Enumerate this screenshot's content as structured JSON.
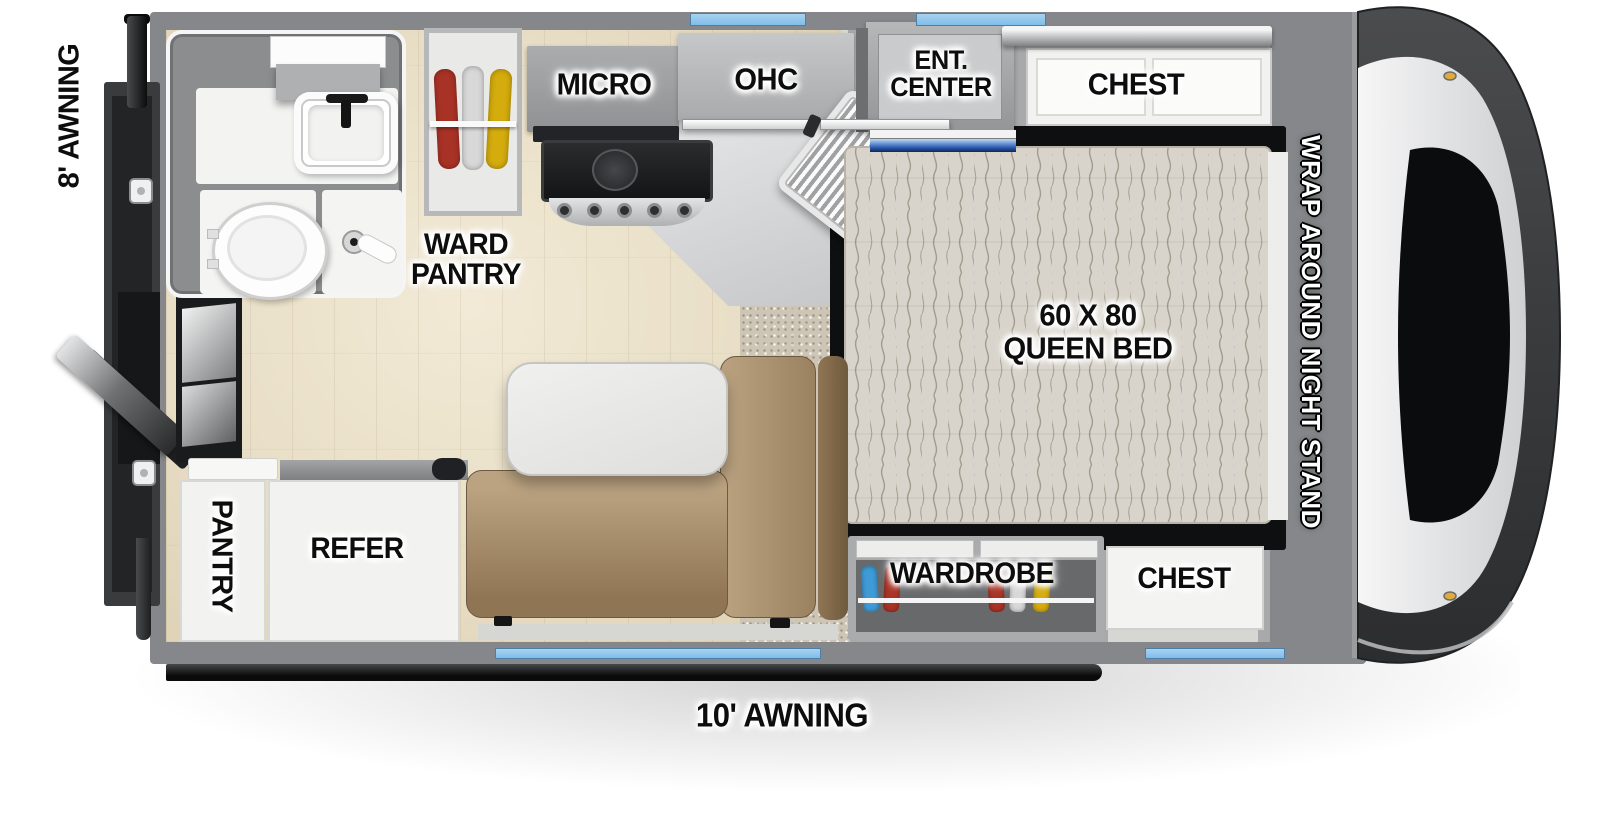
{
  "labels": {
    "awning_left": "8' AWNING",
    "awning_bottom": "10' AWNING",
    "ward_pantry": "WARD PANTRY",
    "micro": "MICRO",
    "ohc": "OHC",
    "ent_center": "ENT. CENTER",
    "chest_front": "CHEST",
    "queen_bed": "60 X 80 QUEEN BED",
    "night_stand": "WRAP AROUND NIGHT STAND",
    "wardrobe": "WARDROBE",
    "chest_rear": "CHEST",
    "pantry": "PANTRY",
    "refer": "REFER"
  },
  "colors": {
    "window_accent": "#7fbde9",
    "ent_led": "#2b5cb8",
    "wall_gray": "#85878a",
    "sofa_tan": "#a78e6c",
    "wood_floor": "#e8dec6",
    "carpet": "#cdc5b5",
    "hanger_red": "#a93226",
    "hanger_yellow": "#d4ac0d",
    "hanger_blue": "#3e9bd6",
    "hanger_white": "#d8d8d8"
  }
}
